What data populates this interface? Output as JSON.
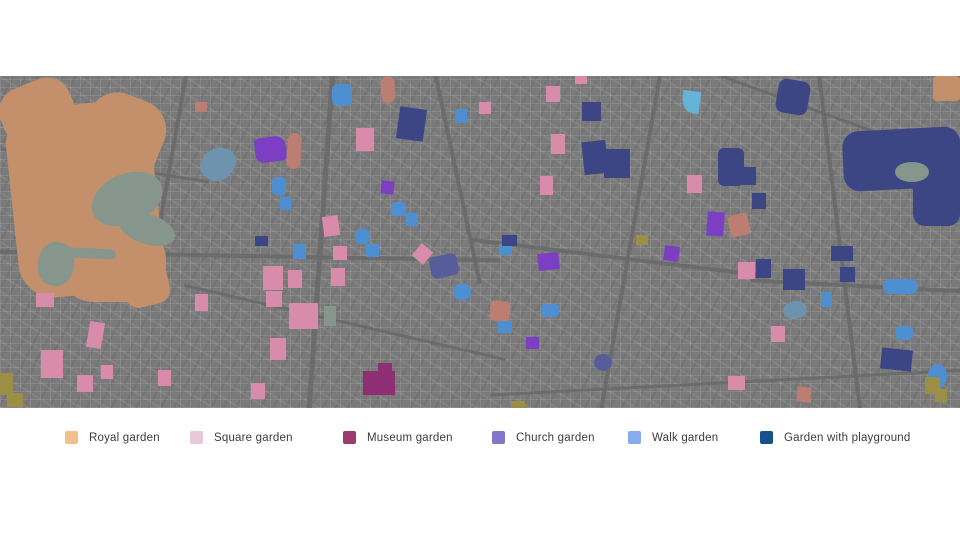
{
  "legend": {
    "items": [
      {
        "label": "Royal garden",
        "color": "#F2C08B",
        "x": 65
      },
      {
        "label": "Square garden",
        "color": "#E7C9D8",
        "x": 190
      },
      {
        "label": "Museum garden",
        "color": "#9E3B6C",
        "x": 343
      },
      {
        "label": "Church garden",
        "color": "#8375C8",
        "x": 492
      },
      {
        "label": "Walk garden",
        "color": "#84ACEE",
        "x": 628
      },
      {
        "label": "Garden with playground",
        "color": "#17518C",
        "x": 760
      }
    ]
  },
  "map": {
    "background": "#7a7a7a",
    "colors": {
      "district": {
        "name": "district-texture",
        "hex": "radial-gradient(closest-side, rgba(225,225,225,0.32), rgba(225,225,225,0.0))"
      },
      "road": {
        "name": "road-line",
        "hex": "rgba(104,104,104,0.85)"
      },
      "royal": {
        "name": "royal-garden-area",
        "hex": "#C3906B"
      },
      "water": {
        "name": "water-area",
        "hex": "#87968C"
      },
      "canal": {
        "name": "canal-area",
        "hex": "#6E93AE"
      },
      "square": {
        "name": "square-garden-area",
        "hex": "#D88CA9"
      },
      "museum": {
        "name": "museum-garden-area",
        "hex": "#8E2E74"
      },
      "church": {
        "name": "church-garden-area",
        "hex": "#7C3FC4"
      },
      "slate": {
        "name": "church-garden-area",
        "hex": "#575C9B"
      },
      "walk": {
        "name": "walk-garden-area",
        "hex": "#4E8FD1"
      },
      "cyan": {
        "name": "walk-garden-area",
        "hex": "#66B3DA"
      },
      "playground": {
        "name": "playground-garden-area",
        "hex": "#3D4684"
      },
      "salmon": {
        "name": "royal-garden-area",
        "hex": "#BC7D72"
      },
      "olive": {
        "name": "park-area",
        "hex": "#9A8F45"
      }
    },
    "shapes": [
      {
        "t": "district",
        "x": 390,
        "y": 70,
        "w": 180,
        "h": 150
      },
      {
        "t": "district",
        "x": 560,
        "y": 180,
        "w": 200,
        "h": 160
      },
      {
        "t": "district",
        "x": 150,
        "y": -20,
        "w": 160,
        "h": 120
      },
      {
        "t": "district",
        "x": 680,
        "y": 0,
        "w": 160,
        "h": 110
      },
      {
        "t": "district",
        "x": 30,
        "y": 200,
        "w": 220,
        "h": 140
      },
      {
        "t": "district",
        "x": 240,
        "y": 10,
        "w": 140,
        "h": 100
      },
      {
        "t": "district",
        "x": 830,
        "y": 210,
        "w": 140,
        "h": 110
      },
      {
        "t": "district",
        "x": 430,
        "y": -20,
        "w": 160,
        "h": 100
      },
      {
        "t": "district",
        "x": 250,
        "y": 150,
        "w": 180,
        "h": 160
      },
      {
        "t": "road",
        "x": 0,
        "y": 178,
        "w": 500,
        "h": 4,
        "r": 1
      },
      {
        "t": "road",
        "x": 470,
        "y": 180,
        "w": 300,
        "h": 4,
        "r": 7
      },
      {
        "t": "road",
        "x": 750,
        "y": 208,
        "w": 220,
        "h": 4,
        "r": 3
      },
      {
        "t": "road",
        "x": 168,
        "y": -10,
        "w": 4,
        "h": 200,
        "r": 10
      },
      {
        "t": "road",
        "x": 318,
        "y": -10,
        "w": 5,
        "h": 360,
        "r": 4
      },
      {
        "t": "road",
        "x": 455,
        "y": -10,
        "w": 4,
        "h": 220,
        "r": -12
      },
      {
        "t": "road",
        "x": 628,
        "y": -10,
        "w": 4,
        "h": 360,
        "r": 10
      },
      {
        "t": "road",
        "x": 838,
        "y": -10,
        "w": 4,
        "h": 360,
        "r": -7
      },
      {
        "t": "road",
        "x": 0,
        "y": 88,
        "w": 210,
        "h": 3,
        "r": 9
      },
      {
        "t": "road",
        "x": 490,
        "y": 305,
        "w": 480,
        "h": 3,
        "r": -3
      },
      {
        "t": "road",
        "x": 180,
        "y": 245,
        "w": 330,
        "h": 3,
        "r": 13
      },
      {
        "t": "road",
        "x": 700,
        "y": 40,
        "w": 270,
        "h": 3,
        "r": 20
      },
      {
        "t": "royal",
        "x": 12,
        "y": 28,
        "w": 145,
        "h": 190,
        "r": -6,
        "br": "36px"
      },
      {
        "t": "royal",
        "x": 0,
        "y": 6,
        "w": 74,
        "h": 58,
        "r": -22,
        "br": "24px"
      },
      {
        "t": "royal",
        "x": 76,
        "y": 18,
        "w": 80,
        "h": 118,
        "r": 22,
        "br": "30px"
      },
      {
        "t": "royal",
        "x": 58,
        "y": 148,
        "w": 108,
        "h": 78,
        "br": "36px"
      },
      {
        "t": "royal",
        "x": 122,
        "y": 182,
        "w": 46,
        "h": 48,
        "r": -14,
        "br": "14px"
      },
      {
        "t": "royal",
        "x": 933,
        "y": 0,
        "w": 27,
        "h": 25,
        "br": "4px"
      },
      {
        "t": "playground",
        "x": 843,
        "y": 53,
        "w": 118,
        "h": 60,
        "r": -3,
        "br": "16px"
      },
      {
        "t": "playground",
        "x": 913,
        "y": 92,
        "w": 47,
        "h": 58,
        "br": "12px"
      },
      {
        "t": "playground",
        "x": 777,
        "y": 4,
        "w": 32,
        "h": 34,
        "r": 10,
        "br": "8px"
      },
      {
        "t": "playground",
        "x": 718,
        "y": 72,
        "w": 26,
        "h": 38,
        "br": "6px"
      },
      {
        "t": "water",
        "x": 90,
        "y": 98,
        "w": 74,
        "h": 50,
        "r": -24,
        "br": "50%"
      },
      {
        "t": "water",
        "x": 118,
        "y": 138,
        "w": 58,
        "h": 30,
        "r": 18,
        "br": "50%"
      },
      {
        "t": "water",
        "x": 38,
        "y": 166,
        "w": 36,
        "h": 44,
        "r": 8,
        "br": "45%"
      },
      {
        "t": "water",
        "x": 52,
        "y": 172,
        "w": 64,
        "h": 10,
        "r": 3,
        "br": "5px"
      },
      {
        "t": "water",
        "x": 895,
        "y": 86,
        "w": 34,
        "h": 20,
        "br": "50%"
      },
      {
        "t": "water",
        "x": 324,
        "y": 230,
        "w": 12,
        "h": 20
      },
      {
        "t": "canal",
        "x": 202,
        "y": 70,
        "w": 32,
        "h": 36,
        "r": 35,
        "br": "60% 40% 55% 45%"
      },
      {
        "t": "canal",
        "x": 783,
        "y": 225,
        "w": 24,
        "h": 18,
        "r": -10,
        "br": "50%"
      },
      {
        "t": "church",
        "x": 255,
        "y": 61,
        "w": 31,
        "h": 25,
        "r": -8,
        "br": "4px 10px 4px 8px"
      },
      {
        "t": "church",
        "x": 381,
        "y": 105,
        "w": 13,
        "h": 13,
        "r": 6
      },
      {
        "t": "church",
        "x": 707,
        "y": 136,
        "w": 17,
        "h": 24,
        "r": 4
      },
      {
        "t": "church",
        "x": 538,
        "y": 177,
        "w": 21,
        "h": 17,
        "r": -6
      },
      {
        "t": "church",
        "x": 664,
        "y": 170,
        "w": 15,
        "h": 15,
        "r": 8
      },
      {
        "t": "church",
        "x": 526,
        "y": 261,
        "w": 13,
        "h": 12
      },
      {
        "t": "slate",
        "x": 594,
        "y": 278,
        "w": 18,
        "h": 17,
        "br": "50%"
      },
      {
        "t": "slate",
        "x": 430,
        "y": 179,
        "w": 28,
        "h": 22,
        "r": -12,
        "br": "6px"
      },
      {
        "t": "museum",
        "x": 363,
        "y": 295,
        "w": 32,
        "h": 24
      },
      {
        "t": "museum",
        "x": 378,
        "y": 287,
        "w": 14,
        "h": 13
      },
      {
        "t": "salmon",
        "x": 287,
        "y": 57,
        "w": 14,
        "h": 36,
        "r": 4,
        "br": "7px"
      },
      {
        "t": "salmon",
        "x": 381,
        "y": 0,
        "w": 14,
        "h": 27,
        "r": -3,
        "br": "7px"
      },
      {
        "t": "salmon",
        "x": 729,
        "y": 138,
        "w": 20,
        "h": 22,
        "r": -12,
        "br": "4px"
      },
      {
        "t": "salmon",
        "x": 490,
        "y": 225,
        "w": 20,
        "h": 20,
        "r": 5,
        "br": "4px"
      },
      {
        "t": "salmon",
        "x": 797,
        "y": 311,
        "w": 14,
        "h": 15,
        "r": 6
      },
      {
        "t": "salmon",
        "x": 195,
        "y": 26,
        "w": 12,
        "h": 10
      },
      {
        "t": "square",
        "x": 356,
        "y": 52,
        "w": 18,
        "h": 23
      },
      {
        "t": "square",
        "x": 323,
        "y": 140,
        "w": 16,
        "h": 20,
        "r": -8
      },
      {
        "t": "square",
        "x": 546,
        "y": 10,
        "w": 14,
        "h": 16
      },
      {
        "t": "square",
        "x": 575,
        "y": 0,
        "w": 12,
        "h": 8
      },
      {
        "t": "square",
        "x": 551,
        "y": 58,
        "w": 14,
        "h": 20
      },
      {
        "t": "square",
        "x": 540,
        "y": 100,
        "w": 13,
        "h": 19
      },
      {
        "t": "square",
        "x": 687,
        "y": 99,
        "w": 15,
        "h": 18
      },
      {
        "t": "square",
        "x": 36,
        "y": 217,
        "w": 18,
        "h": 14
      },
      {
        "t": "square",
        "x": 195,
        "y": 218,
        "w": 13,
        "h": 17
      },
      {
        "t": "square",
        "x": 88,
        "y": 246,
        "w": 15,
        "h": 26,
        "r": 10
      },
      {
        "t": "square",
        "x": 41,
        "y": 274,
        "w": 22,
        "h": 28
      },
      {
        "t": "square",
        "x": 77,
        "y": 299,
        "w": 16,
        "h": 17
      },
      {
        "t": "square",
        "x": 101,
        "y": 289,
        "w": 12,
        "h": 14
      },
      {
        "t": "square",
        "x": 158,
        "y": 294,
        "w": 13,
        "h": 16
      },
      {
        "t": "square",
        "x": 333,
        "y": 170,
        "w": 14,
        "h": 14
      },
      {
        "t": "square",
        "x": 415,
        "y": 170,
        "w": 15,
        "h": 16,
        "r": 40
      },
      {
        "t": "square",
        "x": 263,
        "y": 190,
        "w": 20,
        "h": 24
      },
      {
        "t": "square",
        "x": 266,
        "y": 215,
        "w": 16,
        "h": 16
      },
      {
        "t": "square",
        "x": 288,
        "y": 194,
        "w": 14,
        "h": 18
      },
      {
        "t": "square",
        "x": 289,
        "y": 227,
        "w": 29,
        "h": 26
      },
      {
        "t": "square",
        "x": 270,
        "y": 262,
        "w": 16,
        "h": 22
      },
      {
        "t": "square",
        "x": 251,
        "y": 307,
        "w": 14,
        "h": 16
      },
      {
        "t": "square",
        "x": 331,
        "y": 192,
        "w": 14,
        "h": 18
      },
      {
        "t": "square",
        "x": 738,
        "y": 186,
        "w": 17,
        "h": 17
      },
      {
        "t": "square",
        "x": 771,
        "y": 250,
        "w": 14,
        "h": 16
      },
      {
        "t": "square",
        "x": 728,
        "y": 300,
        "w": 17,
        "h": 14
      },
      {
        "t": "square",
        "x": 479,
        "y": 26,
        "w": 12,
        "h": 12
      },
      {
        "t": "walk",
        "x": 332,
        "y": 8,
        "w": 20,
        "h": 22,
        "br": "30%"
      },
      {
        "t": "walk",
        "x": 272,
        "y": 101,
        "w": 14,
        "h": 18,
        "br": "30%"
      },
      {
        "t": "walk",
        "x": 280,
        "y": 121,
        "w": 11,
        "h": 13
      },
      {
        "t": "walk",
        "x": 391,
        "y": 126,
        "w": 15,
        "h": 14,
        "br": "30%"
      },
      {
        "t": "walk",
        "x": 406,
        "y": 137,
        "w": 12,
        "h": 13
      },
      {
        "t": "walk",
        "x": 455,
        "y": 33,
        "w": 12,
        "h": 14
      },
      {
        "t": "cyan",
        "x": 682,
        "y": 15,
        "w": 18,
        "h": 22,
        "r": 8,
        "br": "0 0 0 70%"
      },
      {
        "t": "walk",
        "x": 293,
        "y": 168,
        "w": 13,
        "h": 15
      },
      {
        "t": "walk",
        "x": 366,
        "y": 168,
        "w": 13,
        "h": 13
      },
      {
        "t": "walk",
        "x": 453,
        "y": 208,
        "w": 18,
        "h": 16,
        "br": "40%"
      },
      {
        "t": "walk",
        "x": 355,
        "y": 153,
        "w": 15,
        "h": 15,
        "br": "40%"
      },
      {
        "t": "walk",
        "x": 499,
        "y": 168,
        "w": 13,
        "h": 11
      },
      {
        "t": "walk",
        "x": 541,
        "y": 228,
        "w": 18,
        "h": 13,
        "br": "30%"
      },
      {
        "t": "walk",
        "x": 498,
        "y": 245,
        "w": 14,
        "h": 12
      },
      {
        "t": "walk",
        "x": 821,
        "y": 216,
        "w": 11,
        "h": 15
      },
      {
        "t": "walk",
        "x": 883,
        "y": 203,
        "w": 35,
        "h": 15,
        "br": "7px"
      },
      {
        "t": "walk",
        "x": 895,
        "y": 250,
        "w": 18,
        "h": 14,
        "br": "30%"
      },
      {
        "t": "walk",
        "x": 928,
        "y": 288,
        "w": 19,
        "h": 24,
        "br": "50%"
      },
      {
        "t": "playground",
        "x": 398,
        "y": 32,
        "w": 27,
        "h": 32,
        "r": 8
      },
      {
        "t": "playground",
        "x": 582,
        "y": 26,
        "w": 19,
        "h": 19
      },
      {
        "t": "playground",
        "x": 583,
        "y": 65,
        "w": 24,
        "h": 33,
        "r": -6
      },
      {
        "t": "playground",
        "x": 604,
        "y": 73,
        "w": 26,
        "h": 29
      },
      {
        "t": "playground",
        "x": 502,
        "y": 159,
        "w": 15,
        "h": 11
      },
      {
        "t": "playground",
        "x": 255,
        "y": 160,
        "w": 13,
        "h": 10
      },
      {
        "t": "playground",
        "x": 742,
        "y": 91,
        "w": 14,
        "h": 18
      },
      {
        "t": "playground",
        "x": 752,
        "y": 117,
        "w": 14,
        "h": 16
      },
      {
        "t": "playground",
        "x": 756,
        "y": 183,
        "w": 15,
        "h": 19
      },
      {
        "t": "playground",
        "x": 783,
        "y": 193,
        "w": 22,
        "h": 21
      },
      {
        "t": "playground",
        "x": 831,
        "y": 170,
        "w": 22,
        "h": 15
      },
      {
        "t": "playground",
        "x": 840,
        "y": 191,
        "w": 15,
        "h": 15
      },
      {
        "t": "playground",
        "x": 881,
        "y": 273,
        "w": 31,
        "h": 21,
        "r": 6
      },
      {
        "t": "olive",
        "x": 636,
        "y": 159,
        "w": 12,
        "h": 10
      },
      {
        "t": "olive",
        "x": 0,
        "y": 297,
        "w": 13,
        "h": 22
      },
      {
        "t": "olive",
        "x": 7,
        "y": 317,
        "w": 16,
        "h": 14
      },
      {
        "t": "olive",
        "x": 511,
        "y": 325,
        "w": 14,
        "h": 7
      },
      {
        "t": "olive",
        "x": 925,
        "y": 301,
        "w": 15,
        "h": 17
      },
      {
        "t": "olive",
        "x": 935,
        "y": 313,
        "w": 12,
        "h": 13
      }
    ]
  }
}
